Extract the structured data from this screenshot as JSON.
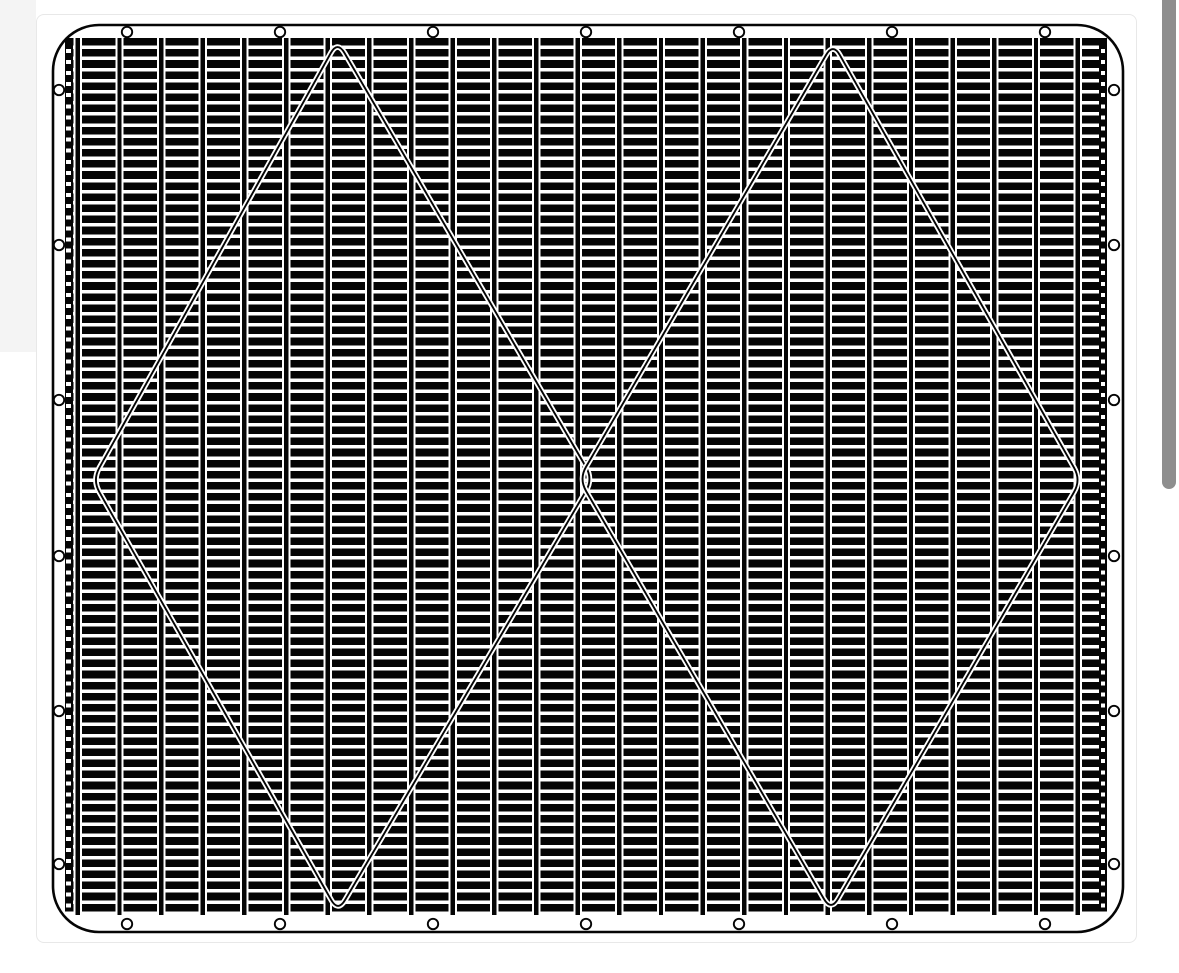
{
  "description": "Black and white CAD-style technical drawing of a rectangular grille mesh panel with rounded corners, perimeter mounting holes, horizontal billet slats between vertical rails, and two large overlapping diamond outlines; shown in a viewer page with a vertical scrollbar",
  "colors": {
    "page_bg": "#ffffff",
    "margin_shade": "#f4f4f4",
    "card_bg": "#ffffff",
    "card_border": "#e8e8e8",
    "ink": "#050505",
    "paper": "#ffffff",
    "scrollbar_thumb": "#8e8e8e"
  },
  "corner_shade": {
    "x": 0,
    "y": 0,
    "w": 36,
    "h": 352
  },
  "card": {
    "x": 36,
    "y": 14,
    "w": 1101,
    "h": 929
  },
  "scrollbar": {
    "x": 1162,
    "y": -8,
    "w": 14,
    "h": 497,
    "radius": 7
  },
  "drawing": {
    "frame": {
      "x": 53,
      "y": 25,
      "w": 1070,
      "h": 907,
      "radius": 46,
      "stroke_w": 2.6
    },
    "holes": {
      "radius": 5.2,
      "stroke_w": 1.9,
      "top": {
        "y": 32,
        "xs": [
          127,
          280,
          433,
          586,
          739,
          892,
          1045
        ]
      },
      "bottom": {
        "y": 924,
        "xs": [
          127,
          280,
          433,
          586,
          739,
          892,
          1045
        ]
      },
      "left": {
        "x": 59,
        "ys": [
          90,
          245,
          400,
          556,
          711,
          864
        ]
      },
      "right": {
        "x": 1114,
        "ys": [
          90,
          245,
          400,
          556,
          711,
          864
        ]
      }
    },
    "grid": {
      "x": 65,
      "y": 37.5,
      "w": 1042,
      "h": 877,
      "row_pitch": 11.1,
      "slat_h": 7.6,
      "col_pitch": 41.66,
      "rail_w": 4.4,
      "rail_gap": 2.0,
      "first_rail_offset": 10.6,
      "strip_w": 8,
      "strip_dot_w": 4.2,
      "strip_dot_h": 4.0,
      "strip_dot_offset": 3.8,
      "left_strip_x": 64.5,
      "right_strip_x": 1099,
      "strip_top": 45,
      "strip_bottom": 910
    },
    "diamonds": [
      {
        "name": "left",
        "points": [
          [
            337.5,
            41
          ],
          [
            593,
            479
          ],
          [
            338,
            912
          ],
          [
            92.5,
            480
          ]
        ]
      },
      {
        "name": "right",
        "points": [
          [
            833,
            43
          ],
          [
            1081,
            480
          ],
          [
            831,
            911
          ],
          [
            579,
            479
          ]
        ]
      }
    ],
    "diamond_style": {
      "casing_w": 5.6,
      "core_w": 1.9,
      "corner_r": 14
    }
  }
}
